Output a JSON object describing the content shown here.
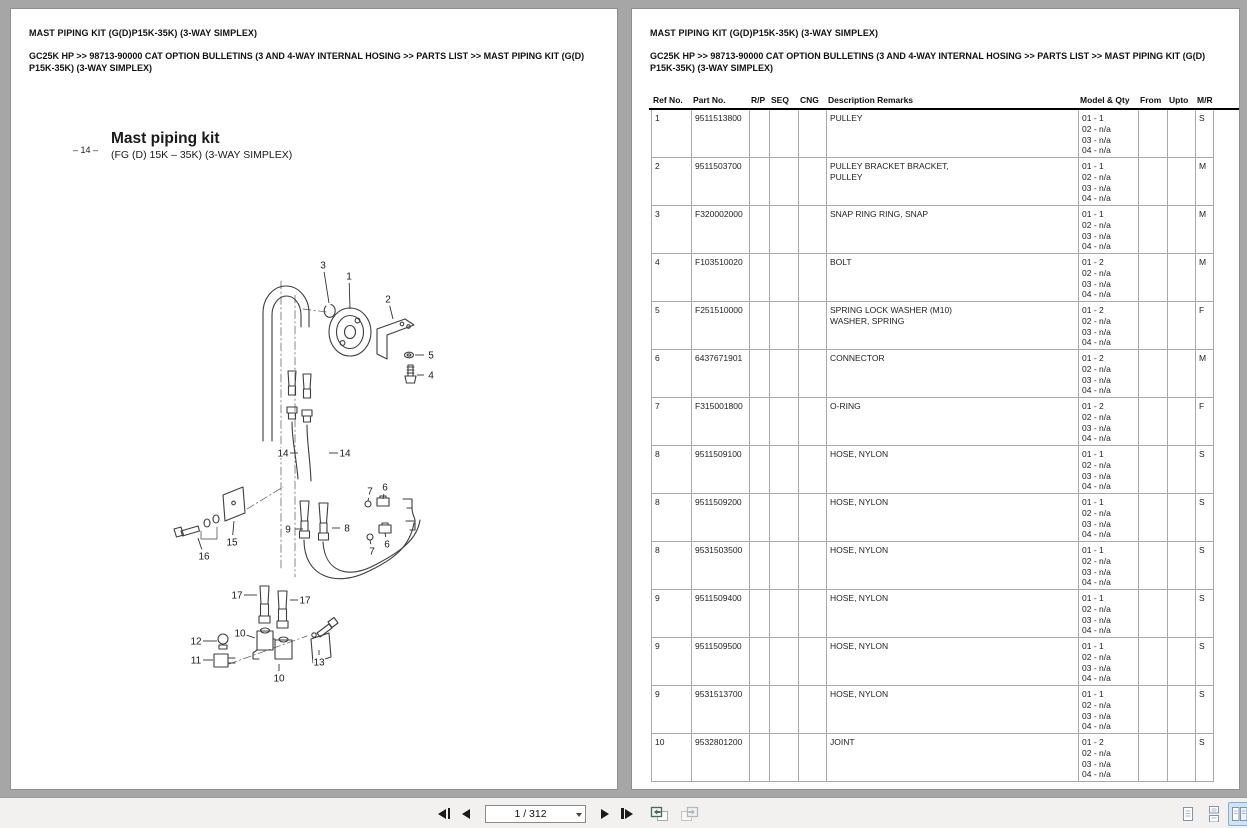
{
  "page_left": {
    "title": "MAST PIPING KIT (G(D)P15K-35K) (3-WAY SIMPLEX)",
    "breadcrumb": "GC25K HP >> 98713-90000 CAT OPTION BULLETINS (3 AND 4-WAY INTERNAL HOSING >> PARTS LIST >> MAST PIPING KIT (G(D) P15K-35K) (3-WAY SIMPLEX)",
    "figure": {
      "page_marker": "– 14 –",
      "title": "Mast piping kit",
      "subtitle": "(FG (D) 15K – 35K)  (3-WAY SIMPLEX)"
    },
    "callouts": [
      {
        "n": "3",
        "x": 312,
        "y": 256,
        "tx": 318,
        "ty": 294
      },
      {
        "n": "1",
        "x": 338,
        "y": 267,
        "tx": 339,
        "ty": 300
      },
      {
        "n": "2",
        "x": 377,
        "y": 290,
        "tx": 382,
        "ty": 310
      },
      {
        "n": "5",
        "x": 420,
        "y": 346,
        "tx": 404,
        "ty": 346
      },
      {
        "n": "4",
        "x": 420,
        "y": 366,
        "tx": 406,
        "ty": 366
      },
      {
        "n": "14",
        "x": 272,
        "y": 444,
        "tx": 287,
        "ty": 444
      },
      {
        "n": "14",
        "x": 334,
        "y": 444,
        "tx": 318,
        "ty": 444
      },
      {
        "n": "15",
        "x": 221,
        "y": 533,
        "tx": 223,
        "ty": 512
      },
      {
        "n": "16",
        "x": 193,
        "y": 547,
        "tx": 187,
        "ty": 529
      },
      {
        "n": "9",
        "x": 277,
        "y": 520,
        "tx": 292,
        "ty": 520
      },
      {
        "n": "8",
        "x": 336,
        "y": 519,
        "tx": 321,
        "ty": 519
      },
      {
        "n": "7",
        "x": 359,
        "y": 482,
        "tx": 357,
        "ty": 492
      },
      {
        "n": "6",
        "x": 374,
        "y": 478,
        "tx": 372,
        "ty": 490
      },
      {
        "n": "7",
        "x": 361,
        "y": 542,
        "tx": 359,
        "ty": 531
      },
      {
        "n": "6",
        "x": 376,
        "y": 535,
        "tx": 374,
        "ty": 524
      },
      {
        "n": "17",
        "x": 226,
        "y": 586,
        "tx": 246,
        "ty": 586
      },
      {
        "n": "17",
        "x": 294,
        "y": 591,
        "tx": 279,
        "ty": 591
      },
      {
        "n": "12",
        "x": 185,
        "y": 632,
        "tx": 206,
        "ty": 632
      },
      {
        "n": "11",
        "x": 185,
        "y": 651,
        "tx": 202,
        "ty": 651
      },
      {
        "n": "10",
        "x": 229,
        "y": 624,
        "tx": 244,
        "ty": 629
      },
      {
        "n": "10",
        "x": 268,
        "y": 669,
        "tx": 268,
        "ty": 655
      },
      {
        "n": "13",
        "x": 308,
        "y": 653,
        "tx": 308,
        "ty": 641
      }
    ]
  },
  "page_right": {
    "title": "MAST PIPING KIT (G(D)P15K-35K) (3-WAY SIMPLEX)",
    "breadcrumb": "GC25K HP >> 98713-90000 CAT OPTION BULLETINS (3 AND 4-WAY INTERNAL HOSING >> PARTS LIST >> MAST PIPING KIT (G(D) P15K-35K) (3-WAY SIMPLEX)",
    "table": {
      "headers": [
        "Ref No.",
        "Part No.",
        "R/P",
        "SEQ",
        "CNG",
        "Description Remarks",
        "Model & Qty",
        "From",
        "Upto",
        "M/R"
      ],
      "rows": [
        {
          "ref": "1",
          "part": "9511513800",
          "rp": "",
          "seq": "",
          "cng": "",
          "desc": [
            "PULLEY"
          ],
          "model_qty": [
            "01 - 1",
            "02 - n/a",
            "03 - n/a",
            "04 - n/a"
          ],
          "from": "",
          "upto": "",
          "mr": "S"
        },
        {
          "ref": "2",
          "part": "9511503700",
          "rp": "",
          "seq": "",
          "cng": "",
          "desc": [
            "PULLEY BRACKET BRACKET,",
            "PULLEY"
          ],
          "model_qty": [
            "01 - 1",
            "02 - n/a",
            "03 - n/a",
            "04 - n/a"
          ],
          "from": "",
          "upto": "",
          "mr": "M"
        },
        {
          "ref": "3",
          "part": "F320002000",
          "rp": "",
          "seq": "",
          "cng": "",
          "desc": [
            "SNAP RING RING, SNAP"
          ],
          "model_qty": [
            "01 - 1",
            "02 - n/a",
            "03 - n/a",
            "04 - n/a"
          ],
          "from": "",
          "upto": "",
          "mr": "M"
        },
        {
          "ref": "4",
          "part": "F103510020",
          "rp": "",
          "seq": "",
          "cng": "",
          "desc": [
            "BOLT"
          ],
          "model_qty": [
            "01 - 2",
            "02 - n/a",
            "03 - n/a",
            "04 - n/a"
          ],
          "from": "",
          "upto": "",
          "mr": "M"
        },
        {
          "ref": "5",
          "part": "F251510000",
          "rp": "",
          "seq": "",
          "cng": "",
          "desc": [
            "SPRING LOCK WASHER (M10)",
            "WASHER, SPRING"
          ],
          "model_qty": [
            "01 - 2",
            "02 - n/a",
            "03 - n/a",
            "04 - n/a"
          ],
          "from": "",
          "upto": "",
          "mr": "F"
        },
        {
          "ref": "6",
          "part": "6437671901",
          "rp": "",
          "seq": "",
          "cng": "",
          "desc": [
            "CONNECTOR"
          ],
          "model_qty": [
            "01 - 2",
            "02 - n/a",
            "03 - n/a",
            "04 - n/a"
          ],
          "from": "",
          "upto": "",
          "mr": "M"
        },
        {
          "ref": "7",
          "part": "F315001800",
          "rp": "",
          "seq": "",
          "cng": "",
          "desc": [
            "O-RING"
          ],
          "model_qty": [
            "01 - 2",
            "02 - n/a",
            "03 - n/a",
            "04 - n/a"
          ],
          "from": "",
          "upto": "",
          "mr": "F"
        },
        {
          "ref": "8",
          "part": "9511509100",
          "rp": "",
          "seq": "",
          "cng": "",
          "desc": [
            "HOSE, NYLON"
          ],
          "model_qty": [
            "01 - 1",
            "02 - n/a",
            "03 - n/a",
            "04 - n/a"
          ],
          "from": "",
          "upto": "",
          "mr": "S"
        },
        {
          "ref": "8",
          "part": "9511509200",
          "rp": "",
          "seq": "",
          "cng": "",
          "desc": [
            "HOSE, NYLON"
          ],
          "model_qty": [
            "01 - 1",
            "02 - n/a",
            "03 - n/a",
            "04 - n/a"
          ],
          "from": "",
          "upto": "",
          "mr": "S"
        },
        {
          "ref": "8",
          "part": "9531503500",
          "rp": "",
          "seq": "",
          "cng": "",
          "desc": [
            "HOSE, NYLON"
          ],
          "model_qty": [
            "01 - 1",
            "02 - n/a",
            "03 - n/a",
            "04 - n/a"
          ],
          "from": "",
          "upto": "",
          "mr": "S"
        },
        {
          "ref": "9",
          "part": "9511509400",
          "rp": "",
          "seq": "",
          "cng": "",
          "desc": [
            "HOSE, NYLON"
          ],
          "model_qty": [
            "01 - 1",
            "02 - n/a",
            "03 - n/a",
            "04 - n/a"
          ],
          "from": "",
          "upto": "",
          "mr": "S"
        },
        {
          "ref": "9",
          "part": "9511509500",
          "rp": "",
          "seq": "",
          "cng": "",
          "desc": [
            "HOSE, NYLON"
          ],
          "model_qty": [
            "01 - 1",
            "02 - n/a",
            "03 - n/a",
            "04 - n/a"
          ],
          "from": "",
          "upto": "",
          "mr": "S"
        },
        {
          "ref": "9",
          "part": "9531513700",
          "rp": "",
          "seq": "",
          "cng": "",
          "desc": [
            "HOSE, NYLON"
          ],
          "model_qty": [
            "01 - 1",
            "02 - n/a",
            "03 - n/a",
            "04 - n/a"
          ],
          "from": "",
          "upto": "",
          "mr": "S"
        },
        {
          "ref": "10",
          "part": "9532801200",
          "rp": "",
          "seq": "",
          "cng": "",
          "desc": [
            "JOINT"
          ],
          "model_qty": [
            "01 - 2",
            "02 - n/a",
            "03 - n/a",
            "04 - n/a"
          ],
          "from": "",
          "upto": "",
          "mr": "S"
        }
      ]
    }
  },
  "toolbar": {
    "page_indicator": "1 / 312"
  },
  "colors": {
    "background": "#a6a6a6",
    "toolbar_bg": "#f2f1ef",
    "page_bg": "#ffffff",
    "selected_layout_bg": "#cfe3f7",
    "selected_layout_border": "#84aed6"
  }
}
